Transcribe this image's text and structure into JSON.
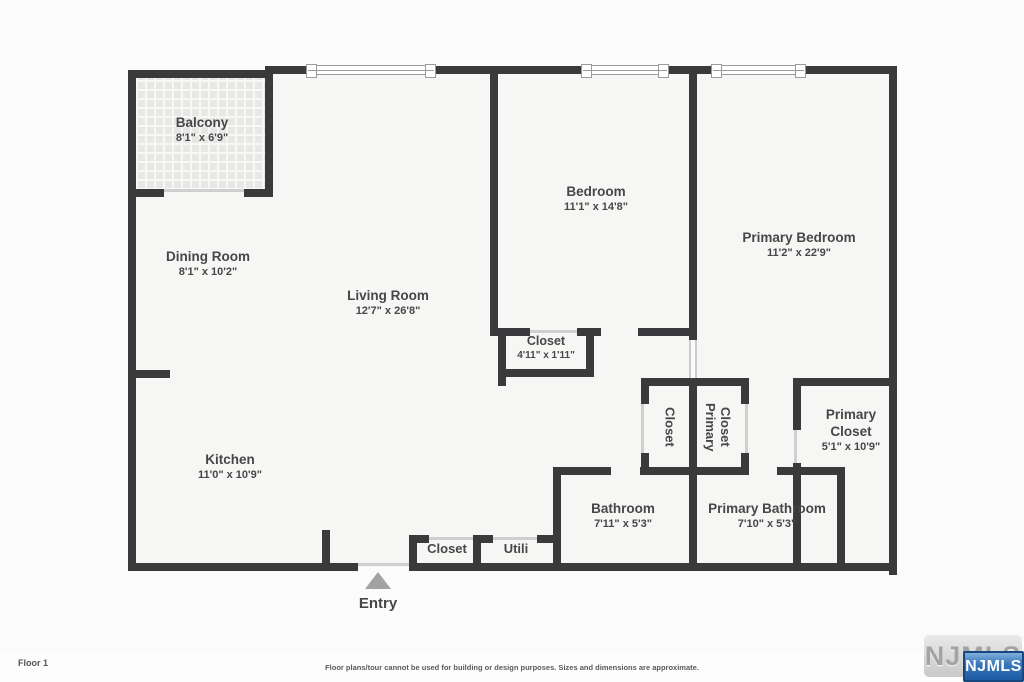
{
  "colors": {
    "wall": "#3a3a3c",
    "floor": "#f6f6f5",
    "badge_blue": "#1c5ca5",
    "entry_arrow": "#a2a2a2"
  },
  "rooms": {
    "balcony": {
      "name": "Balcony",
      "dims": "8'1\" x 6'9\""
    },
    "dining": {
      "name": "Dining Room",
      "dims": "8'1\" x 10'2\""
    },
    "living": {
      "name": "Living Room",
      "dims": "12'7\" x 26'8\""
    },
    "kitchen": {
      "name": "Kitchen",
      "dims": "11'0\" x 10'9\""
    },
    "bedroom": {
      "name": "Bedroom",
      "dims": "11'1\" x 14'8\""
    },
    "primary_bedroom": {
      "name": "Primary Bedroom",
      "dims": "11'2\" x 22'9\""
    },
    "bedroom_closet": {
      "name": "Closet",
      "dims": "4'11\" x 1'11\""
    },
    "hall_closet": {
      "name": "Closet"
    },
    "primary_closet_small": {
      "name": "Primary Closet"
    },
    "primary_closet": {
      "name": "Primary Closet",
      "dims": "5'1\" x 10'9\""
    },
    "bathroom": {
      "name": "Bathroom",
      "dims": "7'11\" x 5'3\""
    },
    "primary_bathroom": {
      "name": "Primary Bathroom",
      "dims": "7'10\" x 5'3\""
    },
    "entry_closet": {
      "name": "Closet"
    },
    "utility": {
      "name": "Utili"
    }
  },
  "entry": {
    "label": "Entry"
  },
  "footer": {
    "floor_label": "Floor 1",
    "disclaimer": "Floor plans/tour cannot be used for building or design purposes. Sizes and dimensions are approximate."
  },
  "logo": {
    "watermark": "NJMLS",
    "badge": "NJMLS"
  }
}
